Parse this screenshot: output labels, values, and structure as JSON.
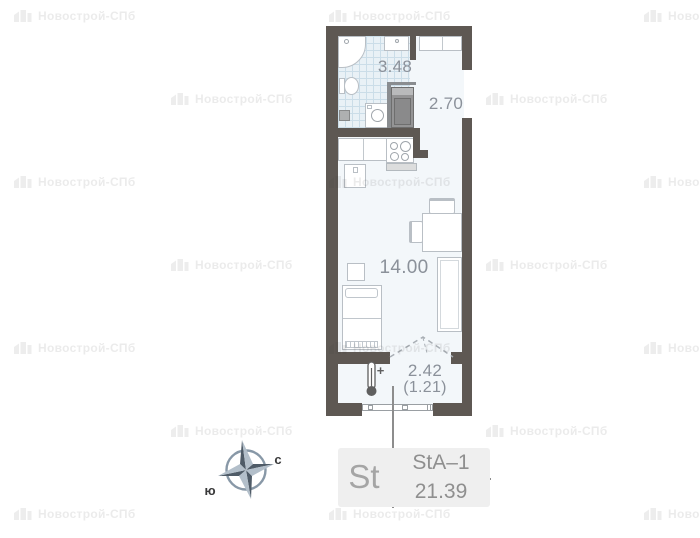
{
  "plan": {
    "areas": {
      "bathroom": "3.48",
      "hallway": "2.70",
      "living": "14.00",
      "balcony": "2.42",
      "balcony_coeff": "(1.21)"
    },
    "thermometer_plus": "+"
  },
  "compass": {
    "south_label": "ю",
    "north_label": "с"
  },
  "unit_card": {
    "type": "St",
    "plan_code": "StA–1",
    "total_area": "21.39"
  },
  "watermark": {
    "text": "Новострой-СПб"
  },
  "colors": {
    "wall": "#5e5853",
    "area_label": "#8b919a",
    "floor": "#f3f7fa",
    "card_bg": "#efefef"
  }
}
